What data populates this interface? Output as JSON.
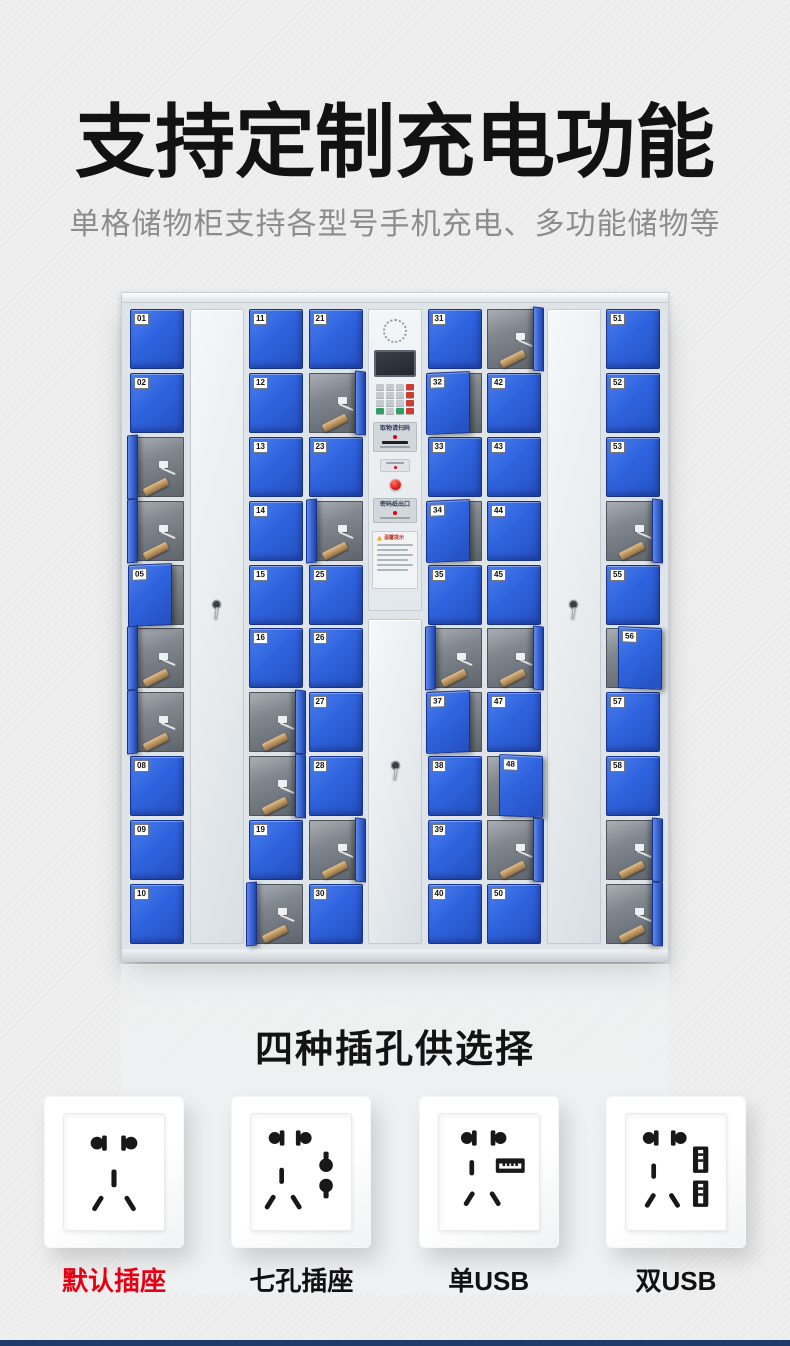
{
  "header": {
    "title": "支持定制充电功能",
    "subtitle": "单格储物柜支持各型号手机充电、多功能储物等"
  },
  "locker": {
    "panel": {
      "scan_label": "取物请扫码",
      "slip_label": "密码纸出口",
      "notice_title": "温馨提示"
    },
    "columns": [
      {
        "type": "cells",
        "cells": [
          {
            "n": "01"
          },
          {
            "n": "02"
          },
          {
            "n": "03",
            "mode": "open",
            "side": "left"
          },
          {
            "n": "04",
            "mode": "open",
            "side": "left"
          },
          {
            "n": "05",
            "mode": "ajar",
            "side": "right"
          },
          {
            "n": "06",
            "mode": "open",
            "side": "left"
          },
          {
            "n": "07",
            "mode": "open",
            "side": "left"
          },
          {
            "n": "08"
          },
          {
            "n": "09"
          },
          {
            "n": "10"
          }
        ]
      },
      {
        "type": "tall-door"
      },
      {
        "type": "cells",
        "cells": [
          {
            "n": "11"
          },
          {
            "n": "12"
          },
          {
            "n": "13"
          },
          {
            "n": "14"
          },
          {
            "n": "15"
          },
          {
            "n": "16"
          },
          {
            "n": "17",
            "mode": "open",
            "side": "right"
          },
          {
            "n": "18",
            "mode": "open",
            "side": "right"
          },
          {
            "n": "19"
          },
          {
            "n": "20",
            "mode": "open",
            "side": "left"
          }
        ]
      },
      {
        "type": "cells",
        "cells": [
          {
            "n": "21"
          },
          {
            "n": "22",
            "mode": "open",
            "side": "right"
          },
          {
            "n": "23"
          },
          {
            "n": "24",
            "mode": "open",
            "side": "left"
          },
          {
            "n": "25"
          },
          {
            "n": "26"
          },
          {
            "n": "27"
          },
          {
            "n": "28"
          },
          {
            "n": "29",
            "mode": "open",
            "side": "right"
          },
          {
            "n": "30"
          }
        ]
      },
      {
        "type": "panel"
      },
      {
        "type": "cells",
        "cells": [
          {
            "n": "31"
          },
          {
            "n": "32",
            "mode": "ajar",
            "side": "right"
          },
          {
            "n": "33"
          },
          {
            "n": "34",
            "mode": "ajar",
            "side": "right"
          },
          {
            "n": "35"
          },
          {
            "n": "36",
            "mode": "open",
            "side": "left"
          },
          {
            "n": "37",
            "mode": "ajar",
            "side": "right"
          },
          {
            "n": "38"
          },
          {
            "n": "39"
          },
          {
            "n": "40"
          }
        ]
      },
      {
        "type": "cells",
        "cells": [
          {
            "n": "41",
            "mode": "open",
            "side": "right"
          },
          {
            "n": "42"
          },
          {
            "n": "43"
          },
          {
            "n": "44"
          },
          {
            "n": "45"
          },
          {
            "n": "46",
            "mode": "open",
            "side": "right"
          },
          {
            "n": "47"
          },
          {
            "n": "48",
            "mode": "ajar",
            "side": "left"
          },
          {
            "n": "49",
            "mode": "open",
            "side": "right"
          },
          {
            "n": "50"
          }
        ]
      },
      {
        "type": "tall-door"
      },
      {
        "type": "cells",
        "cells": [
          {
            "n": "51"
          },
          {
            "n": "52"
          },
          {
            "n": "53"
          },
          {
            "n": "54",
            "mode": "open",
            "side": "right"
          },
          {
            "n": "55"
          },
          {
            "n": "56",
            "mode": "ajar",
            "side": "left"
          },
          {
            "n": "57"
          },
          {
            "n": "58"
          },
          {
            "n": "59",
            "mode": "open",
            "side": "right"
          },
          {
            "n": "60",
            "mode": "open",
            "side": "right"
          }
        ]
      }
    ]
  },
  "sockets": {
    "title": "四种插孔供选择",
    "items": [
      {
        "label": "默认插座",
        "face": "five-hole",
        "label_color": "#e60012"
      },
      {
        "label": "七孔插座",
        "face": "seven-hole",
        "label_color": "#111111"
      },
      {
        "label": "单USB",
        "face": "single-usb",
        "label_color": "#111111"
      },
      {
        "label": "双USB",
        "face": "double-usb",
        "label_color": "#111111"
      }
    ]
  },
  "colors": {
    "door_blue": "#2f63de",
    "door_border": "#16328c",
    "accent_red": "#e60012",
    "bottom_bar": "#1d3a68",
    "background": "#efefef",
    "title_black": "#121212",
    "subtitle_gray": "#8c8c8c"
  }
}
